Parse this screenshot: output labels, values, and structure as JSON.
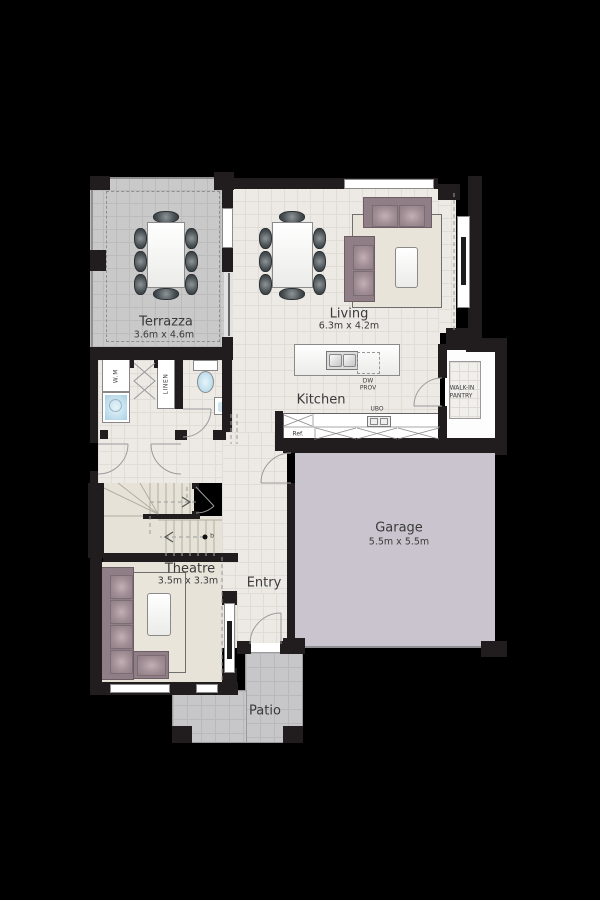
{
  "rooms": {
    "terrazza": {
      "name": "Terrazza",
      "dims": "3.6m  x 4.6m"
    },
    "living": {
      "name": "Living",
      "dims": "6.3m x 4.2m"
    },
    "kitchen": {
      "name": "Kitchen"
    },
    "garage": {
      "name": "Garage",
      "dims": "5.5m x 5.5m"
    },
    "theatre": {
      "name": "Theatre",
      "dims": "3.5m x 3.3m"
    },
    "entry": {
      "name": "Entry"
    },
    "patio": {
      "name": "Patio"
    },
    "pantry": {
      "line1": "WALK-IN",
      "line2": "PANTRY"
    }
  },
  "fixtures": {
    "washing_machine": "W.M",
    "linen": "LINEN",
    "fridge": "Ref.",
    "oven": "UBO",
    "dishwasher": {
      "line1": "DW",
      "line2": "PROV"
    },
    "meter": "b"
  },
  "colors": {
    "background": "#000000",
    "interior_floor": "#EDEAE6",
    "terrazza_floor": "#C9C9C9",
    "garage_floor": "#C9C4CE",
    "patio_floor": "#C7C7C9",
    "wall": "#211D1E",
    "sofa": "#8F7E85",
    "label_text": "#3A3A3A"
  }
}
